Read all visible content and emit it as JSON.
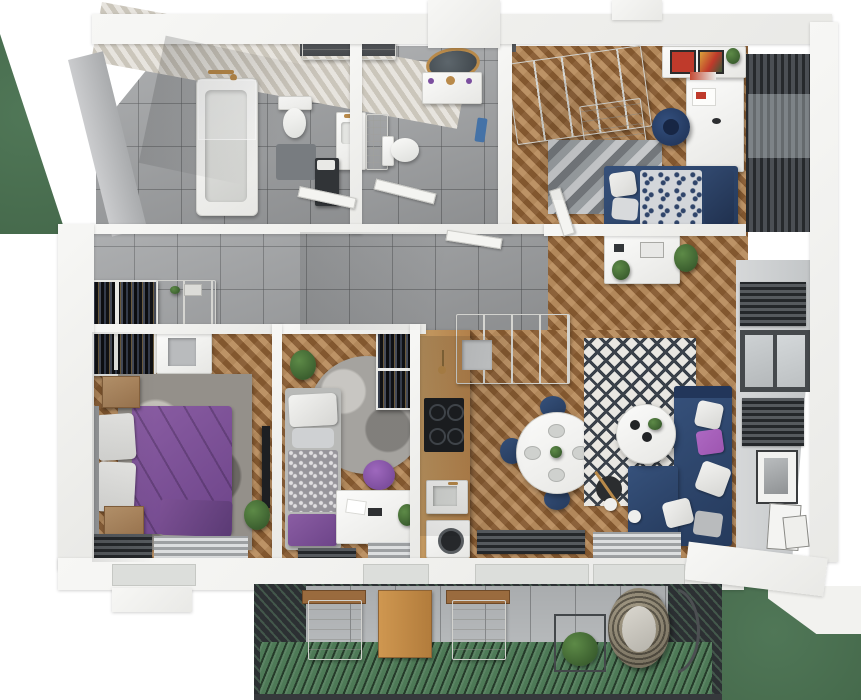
{
  "app": {
    "title": "3D apartment floor plan render"
  },
  "scene": {
    "type": "isometric-top-down-3d-floor-plan-render",
    "background": "white with grass patches at left edge and bottom-right",
    "rooms": [
      {
        "name": "bathroom",
        "features": [
          "bathtub",
          "glass-shower-screen",
          "wall-hung-toilet",
          "washbasin-cabinet",
          "dark-laundry-cabinet",
          "grey-tile-floor",
          "herringbone-tile-accent-wall",
          "brass-fixtures"
        ]
      },
      {
        "name": "wc-bathroom",
        "features": [
          "round-gold-framed-mirror",
          "white-vanity-with-sink",
          "toilet",
          "white-tiled-partition",
          "blue-towel",
          "grey-tile-floor"
        ]
      },
      {
        "name": "hallway",
        "features": [
          "grey-tile-floor",
          "two-open-wardrobes-with-clothes",
          "white-cabinets",
          "open-door-leaves",
          "recessed-shelf-niche"
        ]
      },
      {
        "name": "master-bedroom",
        "features": [
          "double-bed-purple-bedding",
          "stacked-white-pillows",
          "two-wooden-nightstands",
          "mottled-grey-rug",
          "wall-mounted-tv",
          "radiators",
          "herringbone-wood-floor",
          "plant"
        ]
      },
      {
        "name": "kids-bedroom",
        "features": [
          "single-bed-grey-and-purple-bedding",
          "round-grey-rug",
          "purple-pouf",
          "white-desk",
          "black-open-wardrobe",
          "plant",
          "herringbone-wood-floor"
        ]
      },
      {
        "name": "office-bedroom",
        "features": [
          "large-white-wardrobe",
          "white-desk",
          "navy-office-chair",
          "single-bed-navy-patterned-bedding",
          "grey-chevron-rug",
          "wall-shelf-with-red-art",
          "dark-slat-blinds",
          "herringbone-wood-floor"
        ]
      },
      {
        "name": "kitchen",
        "features": [
          "wooden-counter-run",
          "black-induction-cooktop",
          "sink",
          "washing-machine",
          "white-upper-cabinet-block",
          "brass-pendant"
        ]
      },
      {
        "name": "dining-area",
        "features": [
          "round-white-table",
          "four-place-settings",
          "four-navy-chairs",
          "centre-plant"
        ]
      },
      {
        "name": "living-room",
        "features": [
          "navy-corner-sofa",
          "white-grey-purple-throw-pillows",
          "round-white-coffee-table",
          "diamond-pattern-rug",
          "arc-floor-lamp-with-two-globes",
          "white-sideboard-with-plants",
          "framed-pictures-on-wall",
          "window-with-radiators"
        ]
      },
      {
        "name": "balcony",
        "features": [
          "green-slat-decking",
          "concrete-tile-band",
          "two-white-loungers-with-side-tables",
          "wooden-table",
          "plant-in-wire-cube-stand",
          "hanging-rattan-egg-chair",
          "dark-slat-corners"
        ]
      }
    ]
  },
  "palette": {
    "wall": "#f3f3f0",
    "tile": "#a2a4a6",
    "wood": "#9e6e3f",
    "wood-counter": "#c49a62",
    "cream": "#d9d4ca",
    "navy": "#253a5c",
    "purple": "#6d4489",
    "purple-light": "#9e56b0",
    "grass": "#466a4c",
    "deck": "#4e7a57",
    "slat": "#2c3033",
    "radiator": "#3a3e42",
    "white-furniture": "#f7f7f5",
    "rug": "#96918b",
    "gold": "#b98a4a",
    "concrete": "#b6b9bb",
    "art-red": "#bf3a2b",
    "towel-blue": "#4472a7",
    "plant": "#2f4f26",
    "black": "#131417"
  }
}
